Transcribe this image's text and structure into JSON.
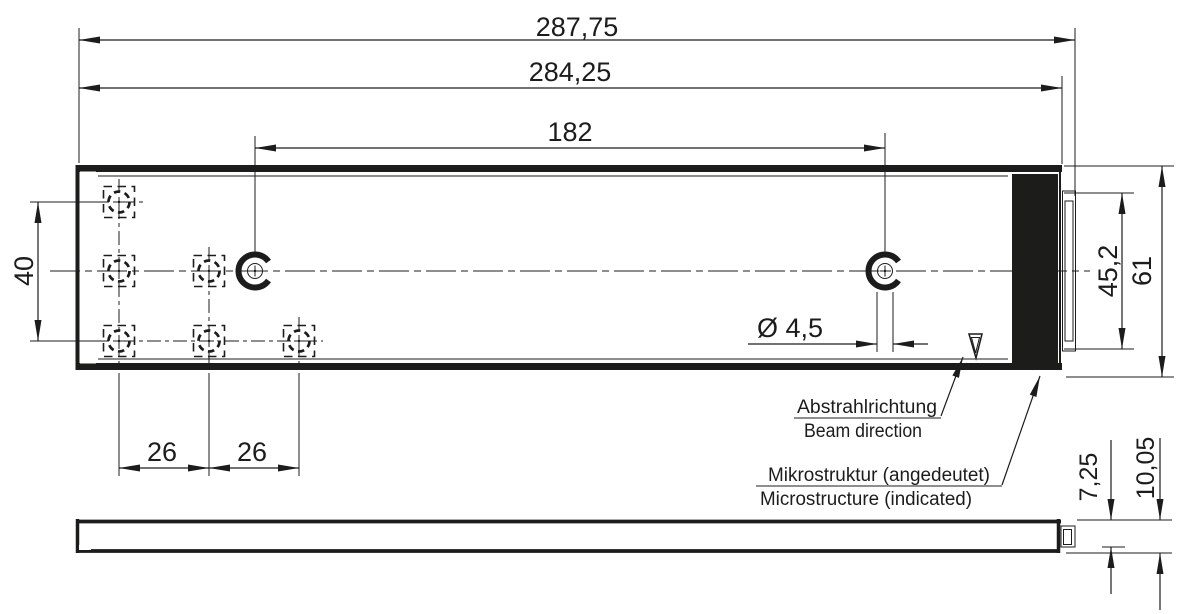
{
  "drawing": {
    "colors": {
      "ink": "#1c1c1b",
      "background": "#ffffff"
    },
    "views": {
      "top_view": "top view of linear light module",
      "side_view": "side view of linear light module"
    },
    "dimensions": {
      "overall_length": "287,75",
      "body_length": "284,25",
      "locating_hole_span": "182",
      "hole_row_spacing": "40",
      "window_height": "45,2",
      "total_height": "61",
      "locating_hole_diameter": "Ø 4,5",
      "hole_pitch_left": "26",
      "hole_pitch_right": "26",
      "window_edge_depth": "7,25",
      "total_depth": "10,05"
    },
    "annotations": {
      "beam_direction": {
        "de": "Abstrahlrichtung",
        "en": "Beam direction"
      },
      "microstructure": {
        "de": "Mikrostruktur (angedeutet)",
        "en": "Microstructure (indicated)"
      }
    }
  }
}
